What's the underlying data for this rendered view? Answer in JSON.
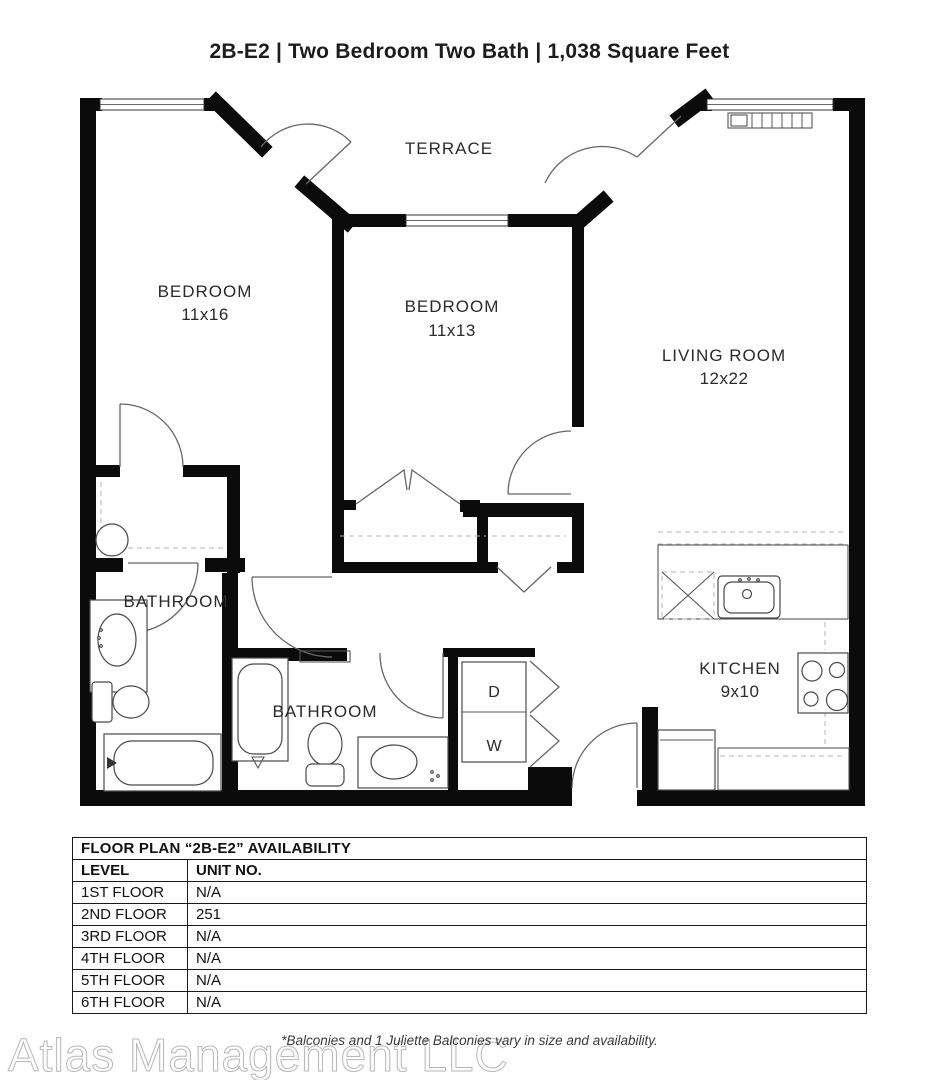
{
  "title": "2B-E2 | Two Bedroom Two Bath | 1,038 Square Feet",
  "floor_plan": {
    "rooms": [
      {
        "id": "terrace",
        "label": "TERRACE",
        "dims": ""
      },
      {
        "id": "bedroom-1",
        "label": "BEDROOM",
        "dims": "11x16"
      },
      {
        "id": "bedroom-2",
        "label": "BEDROOM",
        "dims": "11x13"
      },
      {
        "id": "living-room",
        "label": "LIVING ROOM",
        "dims": "12x22"
      },
      {
        "id": "bathroom-1",
        "label": "BATHROOM",
        "dims": ""
      },
      {
        "id": "bathroom-2",
        "label": "BATHROOM",
        "dims": ""
      },
      {
        "id": "kitchen",
        "label": "KITCHEN",
        "dims": "9x10"
      }
    ],
    "appliances": {
      "dryer": "D",
      "washer": "W"
    }
  },
  "availability_table": {
    "title": "FLOOR PLAN “2B-E2” AVAILABILITY",
    "columns": [
      "LEVEL",
      "UNIT NO."
    ],
    "rows": [
      [
        "1ST FLOOR",
        "N/A"
      ],
      [
        "2ND FLOOR",
        "251"
      ],
      [
        "3RD FLOOR",
        "N/A"
      ],
      [
        "4TH FLOOR",
        "N/A"
      ],
      [
        "5TH FLOOR",
        "N/A"
      ],
      [
        "6TH FLOOR",
        "N/A"
      ]
    ]
  },
  "footnote": "*Balconies and 1 Juliette Balconies vary in size and availability.",
  "watermark": "Atlas Management LLC",
  "colors": {
    "wall": "#0b0b0b",
    "line": "#4a4a4a",
    "dashed": "#b5b5b5",
    "text": "#2a2a2a",
    "table_border": "#1a1a1a",
    "watermark": "#b9b9b9"
  }
}
